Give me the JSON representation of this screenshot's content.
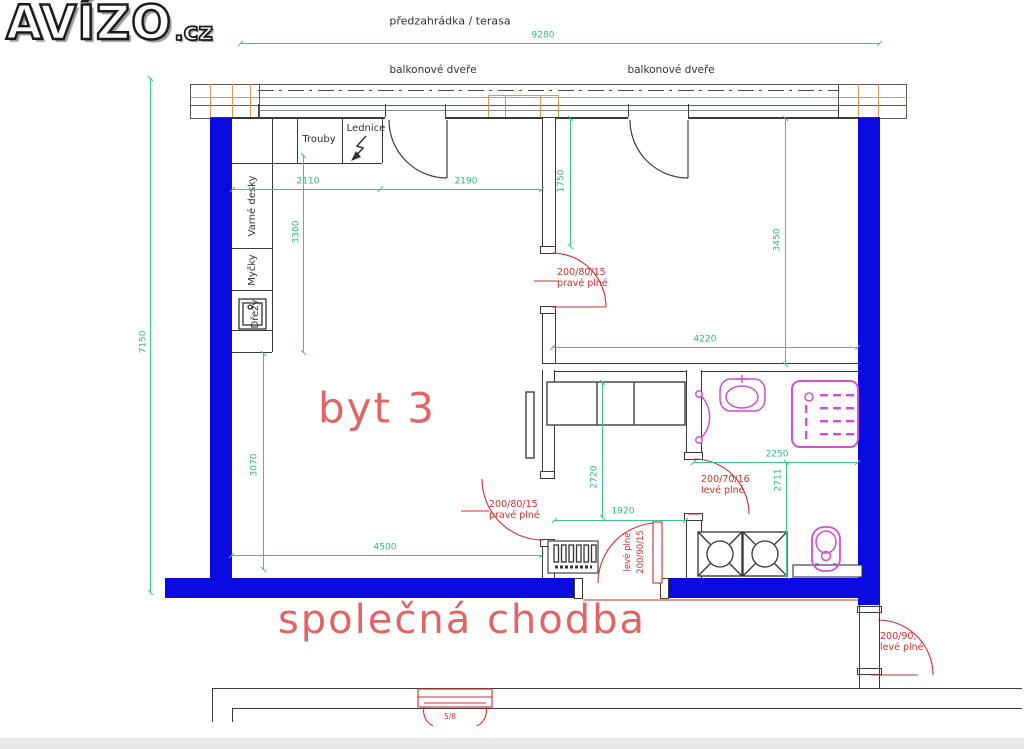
{
  "brand": {
    "logo_main": "AVÍZO",
    "logo_suffix": ".cz"
  },
  "labels": {
    "terrace": "předzahrádka / terasa",
    "balcony_door_left": "balkonové dveře",
    "balcony_door_right": "balkonové dveře",
    "apartment": "byt 3",
    "corridor": "společná chodba"
  },
  "kitchen": {
    "ovens": "Trouby",
    "fridge": "Lednice",
    "cooktops": "Varné desky",
    "dishwashers": "Myčky",
    "sinks": "Dřezy"
  },
  "dimensions": {
    "overall_width": "9280",
    "overall_height": "7150",
    "kitchen_wall_left": "2110",
    "kitchen_wall_right": "2190",
    "kitchen_depth": "3300",
    "living_left": "3070",
    "living_width": "4500",
    "hall_entry": "1750",
    "right_wing": "3450",
    "hall_width": "4220",
    "bath_width": "2250",
    "bath_depth": "2711",
    "bedroom_depth": "2720",
    "bedroom_width": "1920",
    "corridor_passage": "5/8"
  },
  "doors": {
    "hall_size": "200/80/15",
    "hall_type": "pravé plné",
    "living_size": "200/80/15",
    "living_type": "pravé plné",
    "entry_size": "200/90/15",
    "entry_type": "levé plné",
    "bath_size": "200/70/16",
    "bath_type": "levé plné",
    "corridor_size": "200/90,",
    "corridor_type": "levé plné"
  },
  "colors": {
    "wall": "#0a0ae0",
    "dimension_green": "#3fc389",
    "door_red": "#cd2f2f",
    "room_label_pink": "#e06565",
    "fixture_magenta": "#cf4fd0",
    "balcony_tan": "#d79a52",
    "line_dark": "#3c3c3c"
  }
}
